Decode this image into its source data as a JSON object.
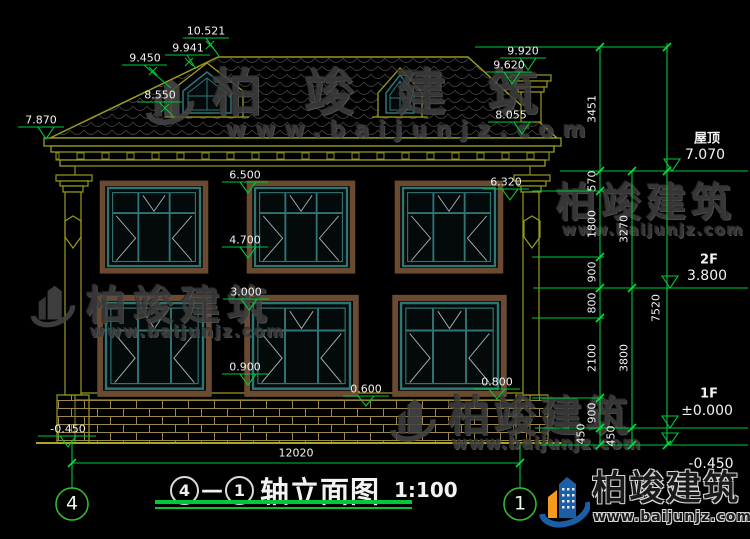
{
  "title": {
    "axis_left": "4",
    "separator": "—",
    "axis_right": "1",
    "name": "轴立面图",
    "scale": "1:100"
  },
  "axis": {
    "left": "4",
    "right": "1"
  },
  "levels": {
    "roof_label": "屋顶",
    "roof_value": "7.070",
    "f2_label": "2F",
    "f2_value": "3.800",
    "f1_label": "1F",
    "f1_value": "±0.000",
    "basement_value": "-0.450"
  },
  "dims": {
    "ridge": "10.521",
    "roof_slope": "9.941",
    "dormer_ridge": "9.450",
    "dormer_eave": "8.550",
    "chimney_top": "9.920",
    "chimney_cap": "9.620",
    "eave_right": "8.055",
    "eave_left": "7.870",
    "f2_window_head_left": "6.500",
    "f2_window_head_right": "6.320",
    "f2_window_sill": "4.700",
    "f1_window_head": "3.000",
    "f1_window_sill": "0.900",
    "plinth_left": "0.600",
    "plinth_right": "0.800",
    "ground_left": "-0.450",
    "overall_width": "12020"
  },
  "chains": {
    "inner": [
      "3451",
      "570",
      "1800",
      "900",
      "800",
      "2100",
      "900",
      "450"
    ],
    "middle": [
      "3270",
      "3800",
      "450"
    ],
    "outer": "7520"
  },
  "watermark": {
    "brand": "柏竣建筑",
    "url": "www.baijunjz.com"
  },
  "colors": {
    "dimension_green": "#00c838",
    "outline_olive": "#9a9a1e",
    "window_teal": "#2e7676",
    "frame_brown": "#6a4a30",
    "logo_blue": "#1b5ea6",
    "logo_orange": "#f59a1d",
    "watermark_gray": "#3e3e3e",
    "text_white": "#f2f2f2"
  }
}
